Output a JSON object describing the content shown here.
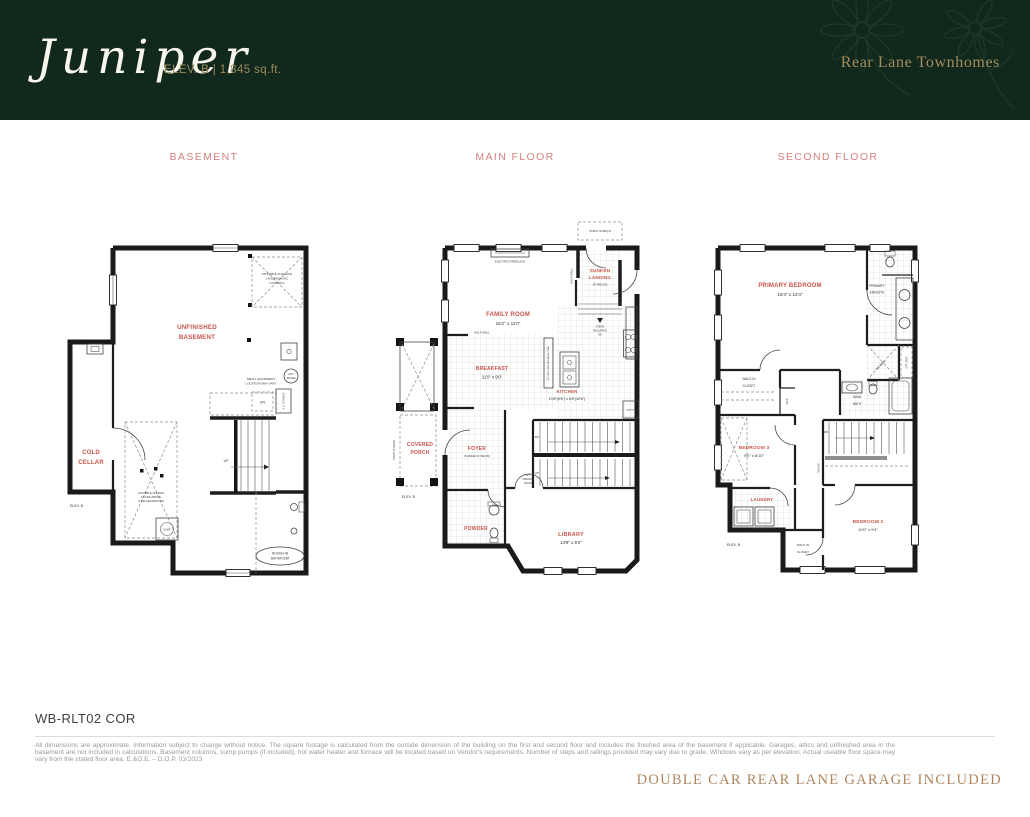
{
  "header": {
    "plan_name": "Juniper",
    "elevation": "ELEV. B | 1,845 sq.ft.",
    "community": "Rear Lane Townhomes"
  },
  "colors": {
    "header_green": "#11291c",
    "gold": "#a18c5f",
    "floor_title_red": "#d5827c",
    "room_label_red": "#c9544b",
    "garage_note_tan": "#ae8560"
  },
  "floor_titles": {
    "basement": "BASEMENT",
    "main": "MAIN FLOOR",
    "second": "SECOND FLOOR"
  },
  "basement": {
    "unfinished1": "UNFINISHED",
    "unfinished2": "BASEMENT",
    "cold1": "COLD",
    "cold2": "CELLAR",
    "furnace_zone1": "POSSIBLE FURNACE",
    "furnace_zone2": "LANDING/HVAC",
    "furnace_zone3": "LOCATION",
    "mech1": "MECH. EQUIPMENT",
    "mech2": "LOCATION MAY VARY",
    "dn": "DN",
    "furnace": "H.E. FURNACE",
    "hot1": "HOT",
    "hot2": "WATER",
    "sump": "SUMP",
    "sunken1": "POSSIBLE SUNKEN",
    "sunken2": "FOYER ABOVE",
    "sunken3": "(LOW HEADROOM)",
    "rough1": "ROUGH-IN",
    "rough2": "BATHROOM",
    "up": "UP",
    "elev": "ELEV. B"
  },
  "main": {
    "family": "FAMILY ROOM",
    "family_dim": "16'2\" x 11'0\"",
    "fireplace": "ELECTRIC FIREPLACE",
    "sunken1": "SUNKEN",
    "sunken2": "LANDING",
    "sunken3": "(IF REQ'D)",
    "steps_top": "STEPS IF REQ'D",
    "steps1": "STEPS",
    "steps2": "REQUIRED",
    "steps3": "DN",
    "half_wall": "HALF WALL",
    "breakfast": "BREAKFAST",
    "breakfast_dim": "11'0\" x 9'0\"",
    "island": "KITCHEN SIDE BREAKFAST BAR",
    "kitchen": "KITCHEN",
    "kitchen_dim": "13'8\"(9'6\") x 6'6\"(10'6\")",
    "pantry": "PANTRY",
    "covered1": "COVERED",
    "covered2": "PORCH",
    "porch_steps": "STEPS IF REQ'D",
    "foyer": "FOYER",
    "foyer_sub": "(SUNKEN IF REQ'D)",
    "powder": "POWDER",
    "library": "LIBRARY",
    "library_dim": "14'8\" x 9'2\"",
    "french1": "OPT.",
    "french2": "FRENCH",
    "french3": "DOOR",
    "dn": "DN",
    "up": "UP",
    "elev": "ELEV. B"
  },
  "second": {
    "primary": "PRIMARY BEDROOM",
    "primary_dim": "16'4\" x 12'4\"",
    "ensuite1": "PRIMARY",
    "ensuite2": "ENSUITE",
    "shower": "SHOWER",
    "opt_seat": "OPT. SEAT",
    "wic1": "WALK-IN",
    "wic2": "CLOSET",
    "bath1": "MAIN",
    "bath2": "BATH",
    "linen": "LINEN",
    "bedroom3": "BEDROOM 3",
    "bedroom3_dim": "9'0\" x 8'10\"",
    "laundry": "LAUNDRY",
    "opt_cab": "OPT. LOWER CABINETS",
    "bedroom2": "BEDROOM 2",
    "bedroom2_dim": "10'0\" x 9'4\"",
    "railing": "RAILING",
    "dn": "DN",
    "elev": "ELEV. B"
  },
  "footer": {
    "model_code": "WB-RLT02 COR",
    "disclaimer": "All dimensions are approximate. Information subject to change without notice. The square footage is calculated from the outside dimension of the building on the first and second floor and includes the finished area of the basement if applicable. Garages, attics and unfinished area in the basement are not included in calculations. Basement columns, sump pumps (if included), hot water heater and furnace will be located based on Vendor's requirements. Number of steps and railings provided may vary due to grade. Windows vary as per elevation. Actual useable floor space may vary from the stated floor area. E.&O.E. – D.O.P. 03/2023",
    "garage_note": "DOUBLE CAR REAR LANE GARAGE INCLUDED"
  }
}
